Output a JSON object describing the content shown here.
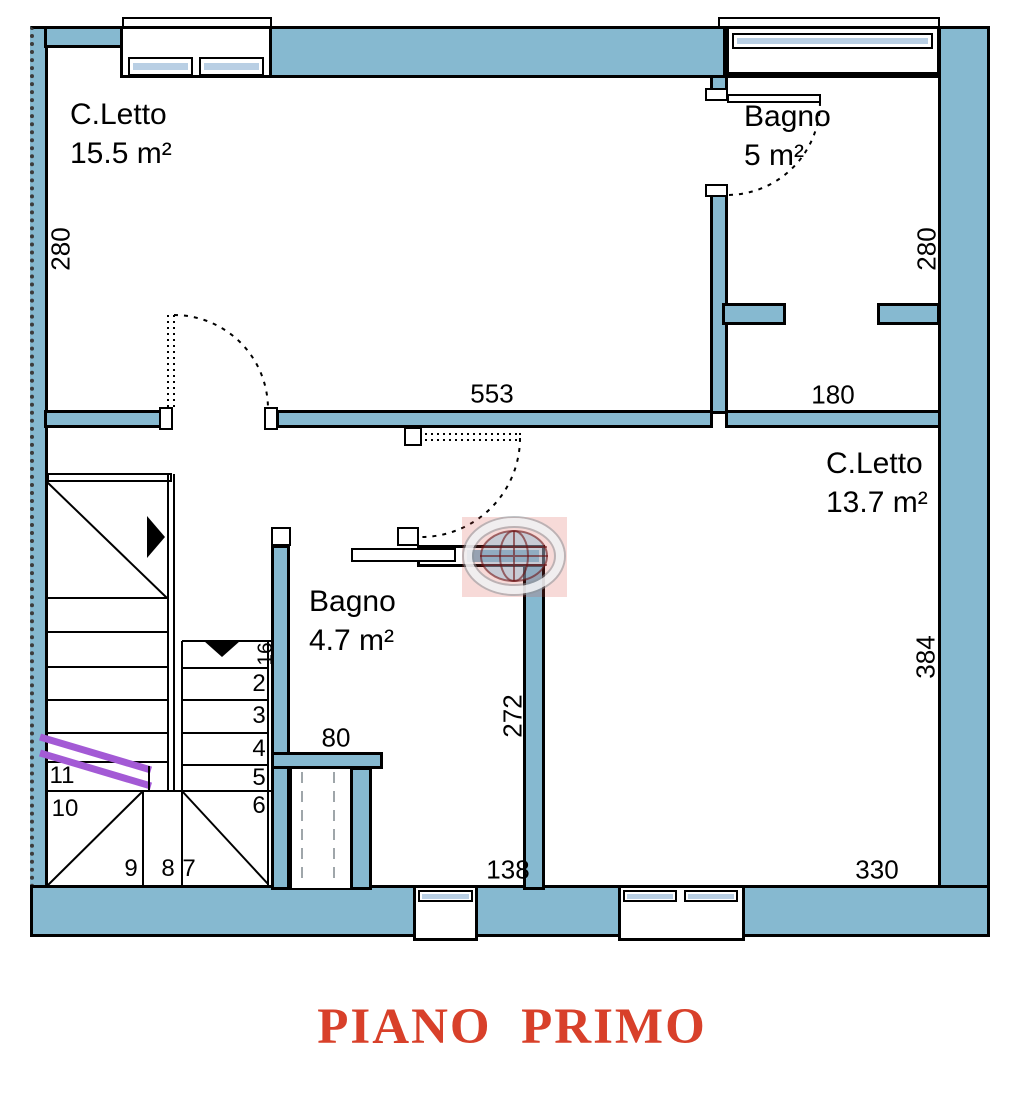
{
  "title": "PIANO  PRIMO",
  "rooms": {
    "bedroom1": {
      "name": "C.Letto",
      "area": "15.5 m²"
    },
    "bath1": {
      "name": "Bagno",
      "area": "5 m²"
    },
    "bedroom2": {
      "name": "C.Letto",
      "area": "13.7 m²"
    },
    "bath2": {
      "name": "Bagno",
      "area": "4.7 m²"
    }
  },
  "dimensions": {
    "bedroom1_height": "280",
    "bedroom1_width": "553",
    "bath1_width": "180",
    "bath1_height": "280",
    "bedroom2_height": "384",
    "bedroom2_width": "330",
    "bath2_right_height": "272",
    "bath2_wall": "80",
    "bottom_left_width": "138",
    "stair_tread": "16"
  },
  "stairs": {
    "numbers": [
      "2",
      "3",
      "4",
      "5",
      "6",
      "7",
      "8",
      "9",
      "10",
      "11"
    ]
  },
  "colors": {
    "wall_fill": "#86B9D0",
    "glass": "#B9CFE4",
    "section_cut": "#A35AD5",
    "title_red": "#D8402A"
  }
}
